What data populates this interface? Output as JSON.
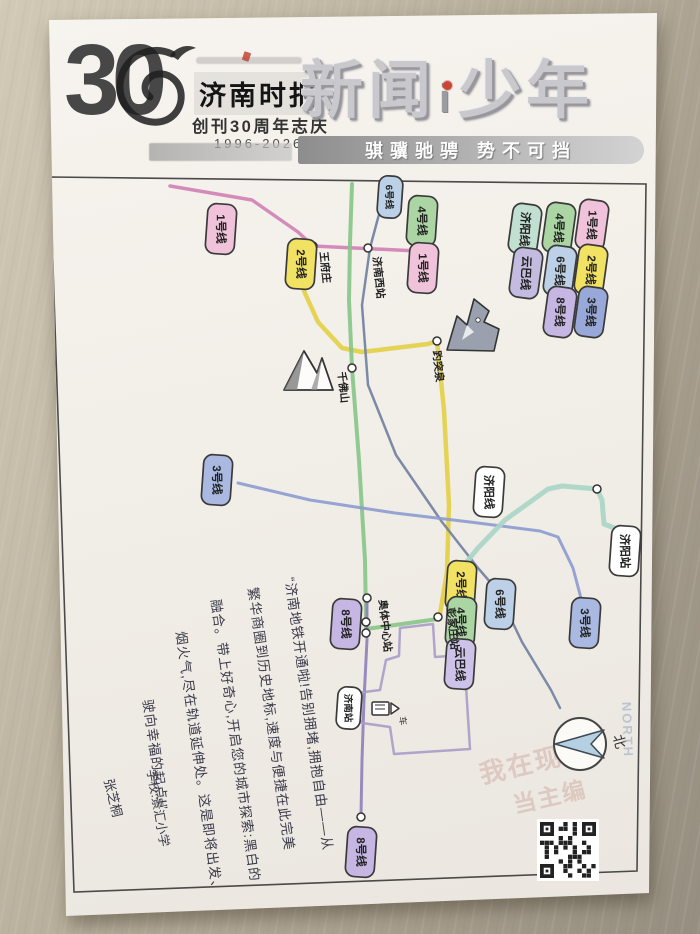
{
  "header": {
    "logo_number": "30",
    "logo_masthead": "济南时报",
    "logo_sub": "创刊30周年志庆",
    "logo_years": "1996-2026",
    "title_part1": "新闻",
    "title_i": "i",
    "title_part2": "少年",
    "slogan": "骐骥驰骋  势不可挡"
  },
  "map": {
    "border": [
      [
        50,
        177
      ],
      [
        646,
        184
      ],
      [
        637,
        871
      ],
      [
        74,
        892
      ]
    ],
    "lines": [
      {
        "label": "1号线",
        "color": "#cf7fb5",
        "width": 3.5,
        "points": [
          [
            170,
            186
          ],
          [
            252,
            200
          ],
          [
            298,
            232
          ],
          [
            313,
            246
          ],
          [
            418,
            251
          ]
        ]
      },
      {
        "label": "2号线",
        "color": "#e3cf45",
        "width": 4.5,
        "points": [
          [
            304,
            291
          ],
          [
            318,
            322
          ],
          [
            342,
            348
          ],
          [
            362,
            352
          ],
          [
            428,
            344
          ],
          [
            437,
            341
          ],
          [
            444,
            410
          ],
          [
            449,
            505
          ],
          [
            447,
            572
          ],
          [
            440,
            614
          ]
        ]
      },
      {
        "label": "4号线",
        "color": "#86c586",
        "width": 4,
        "points": [
          [
            352,
            184
          ],
          [
            350,
            242
          ],
          [
            349,
            300
          ],
          [
            352,
            368
          ],
          [
            359,
            460
          ],
          [
            365,
            560
          ],
          [
            366,
            620
          ],
          [
            366,
            629
          ],
          [
            438,
            619
          ]
        ]
      },
      {
        "label": "6号线",
        "color": "#6f7f9d",
        "width": 2.5,
        "points": [
          [
            388,
            185
          ],
          [
            378,
            218
          ],
          [
            370,
            248
          ],
          [
            362,
            305
          ],
          [
            368,
            385
          ],
          [
            396,
            455
          ],
          [
            442,
            522
          ],
          [
            478,
            568
          ],
          [
            497,
            590
          ],
          [
            522,
            642
          ],
          [
            551,
            690
          ],
          [
            560,
            708
          ]
        ]
      },
      {
        "label": "3号线",
        "color": "#8b9bd0",
        "width": 3,
        "points": [
          [
            238,
            483
          ],
          [
            310,
            500
          ],
          [
            395,
            513
          ],
          [
            470,
            522
          ],
          [
            540,
            531
          ],
          [
            558,
            537
          ],
          [
            573,
            568
          ],
          [
            582,
            602
          ]
        ]
      },
      {
        "label": "济阳线",
        "color": "#a9d6c6",
        "width": 5,
        "points": [
          [
            452,
            580
          ],
          [
            478,
            548
          ],
          [
            505,
            520
          ],
          [
            548,
            489
          ],
          [
            562,
            486
          ],
          [
            597,
            489
          ],
          [
            602,
            500
          ],
          [
            604,
            524
          ],
          [
            622,
            531
          ]
        ]
      },
      {
        "label": "8号线",
        "color": "#8f7fb8",
        "width": 3,
        "points": [
          [
            367,
            598
          ],
          [
            367,
            640
          ],
          [
            364,
            700
          ],
          [
            362,
            760
          ],
          [
            361,
            816
          ]
        ]
      },
      {
        "label": "云巴线",
        "color": "#a89cc8",
        "width": 2.5,
        "closed": true,
        "points": [
          [
            400,
            628
          ],
          [
            433,
            624
          ],
          [
            435,
            657
          ],
          [
            464,
            655
          ],
          [
            470,
            749
          ],
          [
            394,
            754
          ],
          [
            390,
            727
          ],
          [
            362,
            723
          ],
          [
            352,
            707
          ],
          [
            357,
            693
          ],
          [
            380,
            690
          ],
          [
            386,
            660
          ],
          [
            399,
            656
          ]
        ]
      }
    ],
    "badges": [
      {
        "label": "1号线",
        "x": 221,
        "y": 229,
        "color": "#f0c3da"
      },
      {
        "label": "2号线",
        "x": 301,
        "y": 264,
        "color": "#f2e263"
      },
      {
        "label": "6号线",
        "x": 390,
        "y": 197,
        "color": "#bcd0e8",
        "small": true
      },
      {
        "label": "4号线",
        "x": 422,
        "y": 221,
        "color": "#abd6a3"
      },
      {
        "label": "1号线",
        "x": 423,
        "y": 268,
        "color": "#f0c3da"
      },
      {
        "label": "3号线",
        "x": 217,
        "y": 480,
        "color": "#aab9e2"
      },
      {
        "label": "济阳线",
        "x": 489,
        "y": 492,
        "color": "#ffffff"
      },
      {
        "label": "8号线",
        "x": 346,
        "y": 624,
        "color": "#c6b6e4"
      },
      {
        "label": "2号线",
        "x": 461,
        "y": 586,
        "color": "#f2e263"
      },
      {
        "label": "4号线",
        "x": 461,
        "y": 622,
        "color": "#abd6a3"
      },
      {
        "label": "云巴线",
        "x": 460,
        "y": 664,
        "color": "#cdc2e8"
      },
      {
        "label": "6号线",
        "x": 500,
        "y": 604,
        "color": "#bcd0e8"
      },
      {
        "label": "3号线",
        "x": 585,
        "y": 623,
        "color": "#aab9e2"
      },
      {
        "label": "济阳站",
        "x": 625,
        "y": 551,
        "color": "#ffffff"
      },
      {
        "label": "济南站",
        "x": 349,
        "y": 708,
        "color": "#ffffff",
        "small": true
      },
      {
        "label": "8号线",
        "x": 361,
        "y": 852,
        "color": "#c6b6e4"
      }
    ],
    "legend": [
      {
        "label": "1号线",
        "x": 592,
        "y": 225,
        "color": "#f0c3da"
      },
      {
        "label": "4号线",
        "x": 559,
        "y": 228,
        "color": "#abd6a3"
      },
      {
        "label": "济阳线",
        "x": 525,
        "y": 229,
        "color": "#c2e0d2"
      },
      {
        "label": "2号线",
        "x": 591,
        "y": 270,
        "color": "#f2e263"
      },
      {
        "label": "6号线",
        "x": 560,
        "y": 271,
        "color": "#bcd0e8"
      },
      {
        "label": "云巴线",
        "x": 526,
        "y": 273,
        "color": "#c3bce0"
      },
      {
        "label": "3号线",
        "x": 591,
        "y": 312,
        "color": "#98a8d8"
      },
      {
        "label": "8号线",
        "x": 560,
        "y": 312,
        "color": "#c6b6e4"
      }
    ],
    "stations": [
      {
        "x": 313,
        "y": 246,
        "label": "王府庄",
        "lx": 320,
        "ly": 252
      },
      {
        "x": 368,
        "y": 248,
        "label": "济南西站",
        "lx": 373,
        "ly": 257
      },
      {
        "x": 437,
        "y": 341,
        "label": "趵突泉",
        "lx": 433,
        "ly": 351
      },
      {
        "x": 352,
        "y": 368,
        "label": "千佛山",
        "lx": 338,
        "ly": 372
      },
      {
        "x": 366,
        "y": 622,
        "label": "奥体中心站",
        "lx": 379,
        "ly": 600
      },
      {
        "x": 366,
        "y": 633
      },
      {
        "x": 438,
        "y": 617,
        "label": "彭家庄站",
        "lx": 447,
        "ly": 608
      },
      {
        "x": 367,
        "y": 598
      },
      {
        "x": 361,
        "y": 817
      },
      {
        "x": 597,
        "y": 489
      }
    ],
    "train_icon_label": "车",
    "compass": {
      "x": 580,
      "y": 744,
      "r": 26,
      "label": "北",
      "watermark": "NORTH"
    },
    "qr": {
      "x": 540,
      "y": 822,
      "size": 56
    },
    "watermark": {
      "text1": "我在现场",
      "text2": "当主编"
    }
  },
  "note": {
    "lines": [
      "“济南地铁开通啦!告别拥堵,拥抱自由——从",
      "繁华商圈到历史地标,速度与便捷在此完美",
      "融合。带上好奇心,开启您的城市探索:黑白的",
      "烟火气,尽在轨道延伸处。这是即将出发、",
      "驶向幸福的起点!”"
    ]
  },
  "signature": {
    "school": "学校:景汇小学",
    "name": "张芝桐"
  },
  "colors": {
    "paper": "#f3efe9",
    "desk": "#b5ac9b",
    "pen": "#3a3a4a",
    "border": "#4a4a4a"
  }
}
